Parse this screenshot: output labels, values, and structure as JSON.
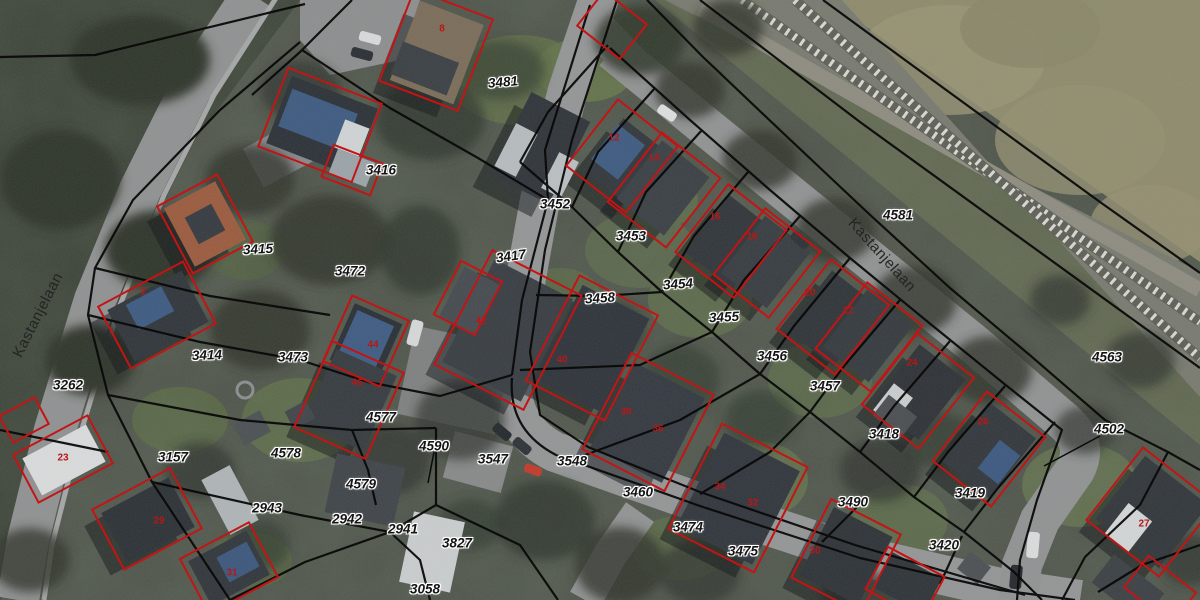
{
  "map": {
    "street_labels": [
      {
        "text": "Kastanjelaan",
        "x": 38,
        "y": 315,
        "rot": -63
      },
      {
        "text": "Kastanjelaan",
        "x": 882,
        "y": 255,
        "rot": 48
      }
    ],
    "parcel_labels": [
      {
        "text": "3481",
        "x": 503,
        "y": 82,
        "rot": -5
      },
      {
        "text": "3416",
        "x": 381,
        "y": 170,
        "rot": 0
      },
      {
        "text": "3452",
        "x": 555,
        "y": 204,
        "rot": 0
      },
      {
        "text": "4581",
        "x": 898,
        "y": 215,
        "rot": 0
      },
      {
        "text": "3453",
        "x": 631,
        "y": 236,
        "rot": 0
      },
      {
        "text": "3415",
        "x": 258,
        "y": 249,
        "rot": -3
      },
      {
        "text": "3417",
        "x": 511,
        "y": 256,
        "rot": -8
      },
      {
        "text": "3472",
        "x": 350,
        "y": 271,
        "rot": 0
      },
      {
        "text": "3454",
        "x": 678,
        "y": 284,
        "rot": -4
      },
      {
        "text": "3458",
        "x": 600,
        "y": 298,
        "rot": -4
      },
      {
        "text": "3455",
        "x": 724,
        "y": 317,
        "rot": -3
      },
      {
        "text": "3414",
        "x": 207,
        "y": 355,
        "rot": -2
      },
      {
        "text": "3473",
        "x": 293,
        "y": 357,
        "rot": 0
      },
      {
        "text": "3456",
        "x": 772,
        "y": 356,
        "rot": 0
      },
      {
        "text": "4563",
        "x": 1107,
        "y": 357,
        "rot": 0
      },
      {
        "text": "3262",
        "x": 68,
        "y": 385,
        "rot": 0
      },
      {
        "text": "3457",
        "x": 825,
        "y": 386,
        "rot": 0
      },
      {
        "text": "4577",
        "x": 381,
        "y": 417,
        "rot": 0
      },
      {
        "text": "4502",
        "x": 1109,
        "y": 429,
        "rot": 0
      },
      {
        "text": "3418",
        "x": 884,
        "y": 434,
        "rot": 0
      },
      {
        "text": "4590",
        "x": 434,
        "y": 446,
        "rot": 0
      },
      {
        "text": "4578",
        "x": 286,
        "y": 453,
        "rot": 0
      },
      {
        "text": "3157",
        "x": 173,
        "y": 457,
        "rot": 0
      },
      {
        "text": "3547",
        "x": 493,
        "y": 459,
        "rot": 0
      },
      {
        "text": "3548",
        "x": 572,
        "y": 461,
        "rot": 0
      },
      {
        "text": "4579",
        "x": 361,
        "y": 484,
        "rot": 0
      },
      {
        "text": "3460",
        "x": 638,
        "y": 492,
        "rot": 0
      },
      {
        "text": "3419",
        "x": 970,
        "y": 493,
        "rot": 0
      },
      {
        "text": "3490",
        "x": 853,
        "y": 502,
        "rot": 0
      },
      {
        "text": "2943",
        "x": 267,
        "y": 508,
        "rot": 0
      },
      {
        "text": "2942",
        "x": 347,
        "y": 519,
        "rot": 0
      },
      {
        "text": "3474",
        "x": 688,
        "y": 527,
        "rot": 0
      },
      {
        "text": "2941",
        "x": 403,
        "y": 529,
        "rot": 0
      },
      {
        "text": "3827",
        "x": 457,
        "y": 543,
        "rot": 0
      },
      {
        "text": "3420",
        "x": 944,
        "y": 545,
        "rot": 0
      },
      {
        "text": "3475",
        "x": 743,
        "y": 551,
        "rot": 0
      },
      {
        "text": "3058",
        "x": 425,
        "y": 589,
        "rot": 0
      }
    ],
    "house_numbers": [
      {
        "text": "8",
        "x": 442,
        "y": 29
      },
      {
        "text": "12",
        "x": 614,
        "y": 138
      },
      {
        "text": "14",
        "x": 654,
        "y": 158
      },
      {
        "text": "16",
        "x": 715,
        "y": 217
      },
      {
        "text": "18",
        "x": 752,
        "y": 237
      },
      {
        "text": "2",
        "x": 143,
        "y": 292
      },
      {
        "text": "20",
        "x": 810,
        "y": 293
      },
      {
        "text": "22",
        "x": 848,
        "y": 311
      },
      {
        "text": "42",
        "x": 481,
        "y": 321
      },
      {
        "text": "44",
        "x": 373,
        "y": 345
      },
      {
        "text": "40",
        "x": 562,
        "y": 360
      },
      {
        "text": "24",
        "x": 912,
        "y": 363
      },
      {
        "text": "46",
        "x": 357,
        "y": 383
      },
      {
        "text": "38",
        "x": 626,
        "y": 412
      },
      {
        "text": "26",
        "x": 983,
        "y": 422
      },
      {
        "text": "36",
        "x": 658,
        "y": 429
      },
      {
        "text": "23",
        "x": 63,
        "y": 458
      },
      {
        "text": "34",
        "x": 720,
        "y": 487
      },
      {
        "text": "32",
        "x": 753,
        "y": 503
      },
      {
        "text": "29",
        "x": 159,
        "y": 521
      },
      {
        "text": "27",
        "x": 1144,
        "y": 524
      },
      {
        "text": "30",
        "x": 815,
        "y": 551
      },
      {
        "text": "31",
        "x": 232,
        "y": 573
      }
    ],
    "colors": {
      "parcel_line": "#0a0a0a",
      "building_outline": "#c41414",
      "parcel_label_text": "#141414",
      "parcel_label_halo": "#ffffff",
      "house_number_text": "#b51818",
      "street_text": "#242424"
    }
  }
}
